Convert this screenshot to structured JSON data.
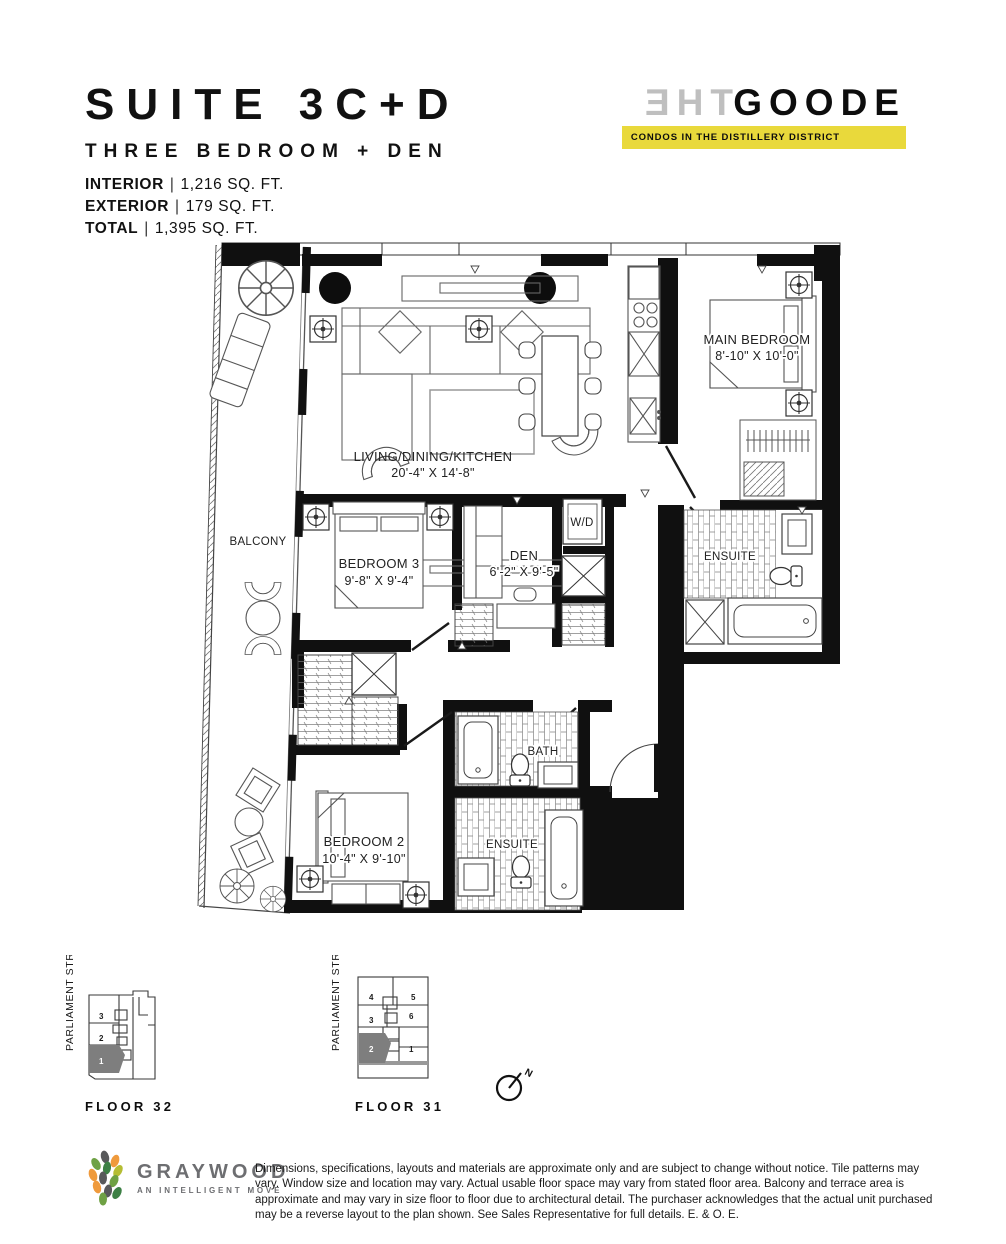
{
  "header": {
    "suite_title": "SUITE 3C+D",
    "suite_subtitle": "THREE BEDROOM + DEN",
    "stats": [
      {
        "label": "INTERIOR",
        "sep": "|",
        "value": "1,216 SQ. FT."
      },
      {
        "label": "EXTERIOR",
        "sep": "|",
        "value": "179 SQ. FT."
      },
      {
        "label": "TOTAL",
        "sep": "|",
        "value": "1,395 SQ. FT."
      }
    ]
  },
  "brand": {
    "name_mirrored": "THE",
    "name_main": "GOODE",
    "tagline": "CONDOS IN THE DISTILLERY DISTRICT",
    "tagline_bg": "#e9d93b"
  },
  "plan": {
    "living": {
      "name": "LIVING/DINING/KITCHEN",
      "dims": "20'-4\" X 14'-8\""
    },
    "main_bedroom": {
      "name": "MAIN BEDROOM",
      "dims": "8'-10\" X 10'-0\""
    },
    "bedroom3": {
      "name": "BEDROOM 3",
      "dims": "9'-8\" X 9'-4\""
    },
    "den": {
      "name": "DEN",
      "dims": "6'-2\" X 9'-5\""
    },
    "bedroom2": {
      "name": "BEDROOM 2",
      "dims": "10'-4\" X 9'-10\""
    },
    "ensuite_main": {
      "name": "ENSUITE"
    },
    "bath": {
      "name": "BATH"
    },
    "ensuite_2": {
      "name": "ENSUITE"
    },
    "laundry": {
      "name": "W/D"
    },
    "balcony": {
      "name": "BALCONY"
    }
  },
  "keyplates": {
    "floor32": {
      "street": "PARLIAMENT STREET",
      "caption": "FLOOR 32",
      "units": [
        "3",
        "2",
        "1"
      ],
      "highlighted_unit": "1"
    },
    "floor31": {
      "street": "PARLIAMENT STREET",
      "caption": "FLOOR 31",
      "units": [
        "4",
        "5",
        "3",
        "6",
        "2",
        "1"
      ],
      "highlighted_unit": "2"
    }
  },
  "compass": {
    "label": "N"
  },
  "footer": {
    "logo_name": "GRAYWOOD",
    "logo_tagline": "AN INTELLIGENT MOVE",
    "disclaimer": "Dimensions, specifications, layouts and materials are approximate only and are subject to change without notice. Tile patterns may vary. Window size and location may vary. Actual usable floor space may vary from stated floor area. Balcony and terrace area is approximate and may vary in size floor to floor due to architectural detail. The purchaser acknowledges that the actual unit purchased may be a reverse layout to the plan shown. See Sales Representative for full details. E. & O. E."
  }
}
